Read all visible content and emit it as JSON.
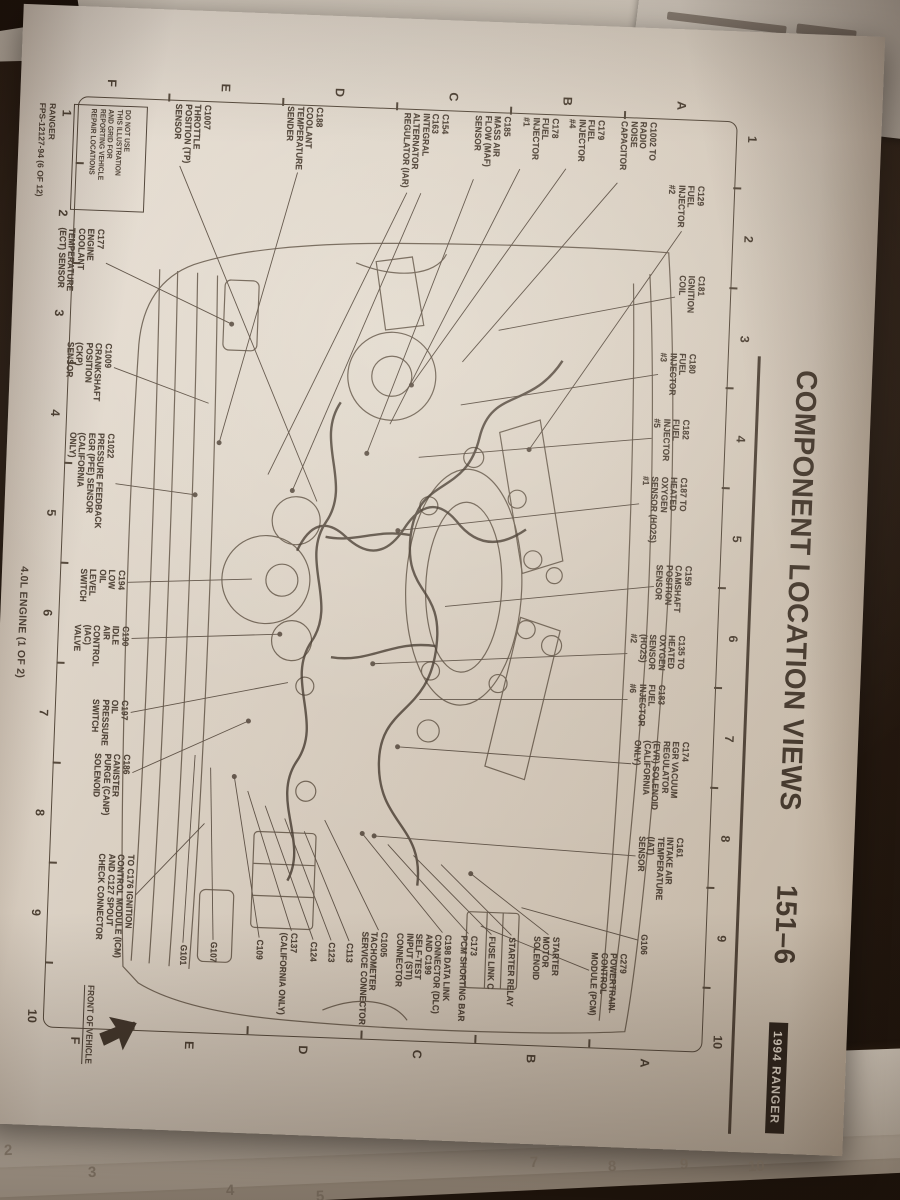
{
  "photo": {
    "header": {
      "title": "COMPONENT LOCATION VIEWS",
      "page_ref": "151–6",
      "badge": "1994 RANGER"
    },
    "grid": {
      "columns": [
        "1",
        "2",
        "3",
        "4",
        "5",
        "6",
        "7",
        "8",
        "9",
        "10"
      ],
      "rows": [
        "A",
        "B",
        "C",
        "D",
        "E",
        "F"
      ]
    },
    "warning_box_lines": [
      "DO NOT USE",
      "THIS ILLUSTRATION",
      "AND GRID FOR",
      "REPORTING VEHICLE",
      "REPAIR LOCATIONS"
    ],
    "footer": {
      "line1": "RANGER",
      "line2": "FPS-12127-94 (6 OF 12)",
      "caption": "4.0L ENGINE (1 OF 2)"
    },
    "front_of_vehicle": "FRONT OF VEHICLE",
    "colors": {
      "paper": "#d9d2c6",
      "ink": "#4a4036",
      "badge_bg": "#27201a",
      "badge_text": "#ddd6ca"
    },
    "under_page_numbers": [
      {
        "t": "2",
        "x": 4,
        "y": 1142
      },
      {
        "t": "3",
        "x": 88,
        "y": 1164
      },
      {
        "t": "4",
        "x": 226,
        "y": 1182
      },
      {
        "t": "5",
        "x": 316,
        "y": 1188
      },
      {
        "t": "7",
        "x": 530,
        "y": 1154
      },
      {
        "t": "8",
        "x": 608,
        "y": 1158
      },
      {
        "t": "9",
        "x": 680,
        "y": 1156
      },
      {
        "t": "10",
        "x": 748,
        "y": 1158
      }
    ],
    "callouts": [
      {
        "lines": [
          "C129",
          "FUEL",
          "INJECTOR",
          "#2"
        ],
        "x": 150,
        "y": 164,
        "leaders": [
          [
            196,
            186,
            420,
            330
          ]
        ]
      },
      {
        "lines": [
          "C1002 TO",
          "RADIO",
          "NOISE",
          "CAPACITOR"
        ],
        "x": 88,
        "y": 214,
        "leaders": [
          [
            150,
            252,
            335,
            400
          ]
        ]
      },
      {
        "lines": [
          "C179",
          "FUEL",
          "INJECTOR",
          "#4"
        ],
        "x": 88,
        "y": 266,
        "leaders": [
          [
            138,
            304,
            360,
            450
          ]
        ]
      },
      {
        "lines": [
          "C178",
          "FUEL",
          "INJECTOR",
          "#1"
        ],
        "x": 88,
        "y": 312,
        "leaders": [
          [
            140,
            350,
            400,
            470
          ]
        ]
      },
      {
        "lines": [
          "C185",
          "MASS AIR",
          "FLOW (MAF)",
          "SENSOR"
        ],
        "x": 88,
        "y": 360,
        "leaders": [
          [
            152,
            396,
            430,
            492
          ]
        ]
      },
      {
        "lines": [
          "C154",
          "C163",
          "INTEGRAL",
          "ALTERNATOR",
          "REGULATOR (IAR)"
        ],
        "x": 88,
        "y": 422,
        "leaders": [
          [
            168,
            448,
            470,
            565
          ],
          [
            168,
            462,
            455,
            590
          ]
        ]
      },
      {
        "lines": [
          "C188",
          "COOLANT",
          "TEMPERATURE",
          "SENDER"
        ],
        "x": 86,
        "y": 548,
        "leaders": [
          [
            152,
            572,
            425,
            640
          ]
        ]
      },
      {
        "lines": [
          "C1007",
          "THROTTLE",
          "POSITION (TP)",
          "SENSOR"
        ],
        "x": 88,
        "y": 660,
        "leaders": [
          [
            150,
            690,
            480,
            540
          ]
        ]
      },
      {
        "lines": [
          "C181",
          "IGNITION",
          "COIL"
        ],
        "x": 240,
        "y": 160,
        "leaders": [
          [
            262,
            190,
            302,
            365
          ]
        ]
      },
      {
        "lines": [
          "C180",
          "FUEL",
          "INJECTOR",
          "#3"
        ],
        "x": 318,
        "y": 166,
        "leaders": [
          [
            340,
            204,
            378,
            400
          ]
        ]
      },
      {
        "lines": [
          "C182",
          "FUEL",
          "INJECTOR",
          "#5"
        ],
        "x": 384,
        "y": 170,
        "leaders": [
          [
            404,
            208,
            432,
            440
          ]
        ]
      },
      {
        "lines": [
          "C187 TO",
          "HEATED",
          "OXYGEN",
          "SENSOR (HO2S)",
          "#1"
        ],
        "x": 442,
        "y": 170,
        "leaders": [
          [
            470,
            218,
            506,
            458
          ]
        ]
      },
      {
        "lines": [
          "C159",
          "CAMSHAFT",
          "POSITION",
          "SENSOR"
        ],
        "x": 530,
        "y": 162,
        "leaders": [
          [
            552,
            200,
            580,
            408
          ]
        ]
      },
      {
        "lines": [
          "C135 TO",
          "HEATED",
          "OXYGEN",
          "SENSOR",
          "(HO2S)",
          "#2"
        ],
        "x": 600,
        "y": 166,
        "leaders": [
          [
            620,
            224,
            640,
            478
          ]
        ]
      },
      {
        "lines": [
          "C183",
          "FUEL",
          "INJECTOR",
          "#6"
        ],
        "x": 650,
        "y": 184,
        "leaders": [
          [
            666,
            222,
            674,
            430
          ]
        ]
      },
      {
        "lines": [
          "C174",
          "EGR VACUUM",
          "REGULATOR",
          "(EVR) SOLENOID",
          "(CALIFORNIA",
          "ONLY)"
        ],
        "x": 706,
        "y": 158,
        "leaders": [
          [
            730,
            216,
            722,
            450
          ]
        ]
      },
      {
        "lines": [
          "C161",
          "INTAKE AIR",
          "TEMPERATURE",
          "(IAT)",
          "SENSOR"
        ],
        "x": 802,
        "y": 160,
        "leaders": [
          [
            822,
            208,
            812,
            470
          ]
        ]
      },
      {
        "lines": [
          "G106"
        ],
        "x": 900,
        "y": 192,
        "leaders": [
          [
            906,
            202,
            878,
            320
          ]
        ]
      },
      {
        "lines": [
          "C279",
          "POWERTRAIN",
          "CONTROL",
          "MODULE (PCM)"
        ],
        "x": 920,
        "y": 212,
        "leaders": [
          [
            938,
            250,
            898,
            360
          ]
        ]
      },
      {
        "lines": [
          "STARTER",
          "MOTOR",
          "SOLENOID"
        ],
        "x": 906,
        "y": 280,
        "leaders": [
          [
            904,
            292,
            846,
            372
          ]
        ]
      },
      {
        "lines": [
          "STARTER RELAY"
        ],
        "x": 908,
        "y": 324,
        "leaders": [
          [
            906,
            329,
            838,
            402
          ]
        ]
      },
      {
        "lines": [
          "FUSE LINK C"
        ],
        "x": 908,
        "y": 344,
        "leaders": [
          [
            906,
            349,
            830,
            430
          ]
        ]
      },
      {
        "lines": [
          "C173",
          "PCM SHORTING BAR"
        ],
        "x": 908,
        "y": 362,
        "leaders": [
          [
            906,
            372,
            820,
            456
          ]
        ]
      },
      {
        "lines": [
          "C198 DATA LINK",
          "CONNECTOR (DLC)",
          "AND C199",
          "SELF-TEST",
          "INPUT (STI)",
          "CONNECTOR"
        ],
        "x": 908,
        "y": 388,
        "leaders": [
          [
            906,
            398,
            810,
            482
          ]
        ]
      },
      {
        "lines": [
          "C1005",
          "TACHOMETER",
          "SERVICE CONNECTOR"
        ],
        "x": 908,
        "y": 452,
        "leaders": [
          [
            906,
            462,
            798,
            520
          ]
        ]
      },
      {
        "lines": [
          "C113"
        ],
        "x": 920,
        "y": 486,
        "leaders": [
          [
            918,
            491,
            810,
            540
          ]
        ]
      },
      {
        "lines": [
          "C123"
        ],
        "x": 920,
        "y": 504,
        "leaders": [
          [
            918,
            509,
            798,
            560
          ]
        ]
      },
      {
        "lines": [
          "C124"
        ],
        "x": 920,
        "y": 522,
        "leaders": [
          [
            918,
            527,
            786,
            580
          ]
        ]
      },
      {
        "lines": [
          "C137",
          "(CALIFORNIA ONLY)"
        ],
        "x": 912,
        "y": 542,
        "leaders": [
          [
            910,
            549,
            772,
            598
          ]
        ]
      },
      {
        "lines": [
          "C109"
        ],
        "x": 920,
        "y": 576,
        "leaders": [
          [
            918,
            581,
            758,
            612
          ]
        ]
      },
      {
        "lines": [
          "G107"
        ],
        "x": 924,
        "y": 622,
        "leaders": [
          [
            922,
            627,
            750,
            636
          ]
        ]
      },
      {
        "lines": [
          "G101"
        ],
        "x": 928,
        "y": 652,
        "leaders": [
          [
            926,
            657,
            738,
            652
          ]
        ]
      },
      {
        "lines": [
          "TO C176 IGNITION",
          "CONTROL MODULE (ICM)",
          "AND C127 SPOUT",
          "CHECK CONNECTOR"
        ],
        "x": 840,
        "y": 708,
        "leaders": [
          [
            880,
            706,
            806,
            640
          ]
        ]
      },
      {
        "lines": [
          "C186",
          "CANISTER",
          "PURGE (CANP)",
          "SOLENOID"
        ],
        "x": 740,
        "y": 716,
        "leaders": [
          [
            758,
            714,
            702,
            600
          ]
        ]
      },
      {
        "lines": [
          "C197",
          "OIL",
          "PRESSURE",
          "SWITCH"
        ],
        "x": 686,
        "y": 720,
        "leaders": [
          [
            698,
            718,
            662,
            562
          ]
        ]
      },
      {
        "lines": [
          "C190",
          "IDLE",
          "AIR",
          "CONTROL",
          "(IAC)",
          "VALVE"
        ],
        "x": 612,
        "y": 722,
        "leaders": [
          [
            624,
            720,
            614,
            572
          ]
        ]
      },
      {
        "lines": [
          "C194",
          "LOW",
          "OIL",
          "LEVEL",
          "SWITCH"
        ],
        "x": 556,
        "y": 728,
        "leaders": [
          [
            568,
            726,
            560,
            602
          ]
        ]
      },
      {
        "lines": [
          "C1022",
          "PRESSURE FEEDBACK",
          "EGR (PFE) SENSOR",
          "(CALIFORNIA",
          "ONLY)"
        ],
        "x": 420,
        "y": 744,
        "leaders": [
          [
            470,
            742,
            478,
            662
          ]
        ]
      },
      {
        "lines": [
          "C1009",
          "CRANKSHAFT",
          "POSITION",
          "(CKP)",
          "SENSOR"
        ],
        "x": 330,
        "y": 750,
        "leaders": [
          [
            354,
            748,
            386,
            652
          ]
        ]
      },
      {
        "lines": [
          "C177",
          "ENGINE",
          "COOLANT",
          "TEMPERATURE",
          "(ECT) SENSOR"
        ],
        "x": 216,
        "y": 762,
        "leaders": [
          [
            250,
            760,
            306,
            632
          ]
        ]
      }
    ]
  }
}
